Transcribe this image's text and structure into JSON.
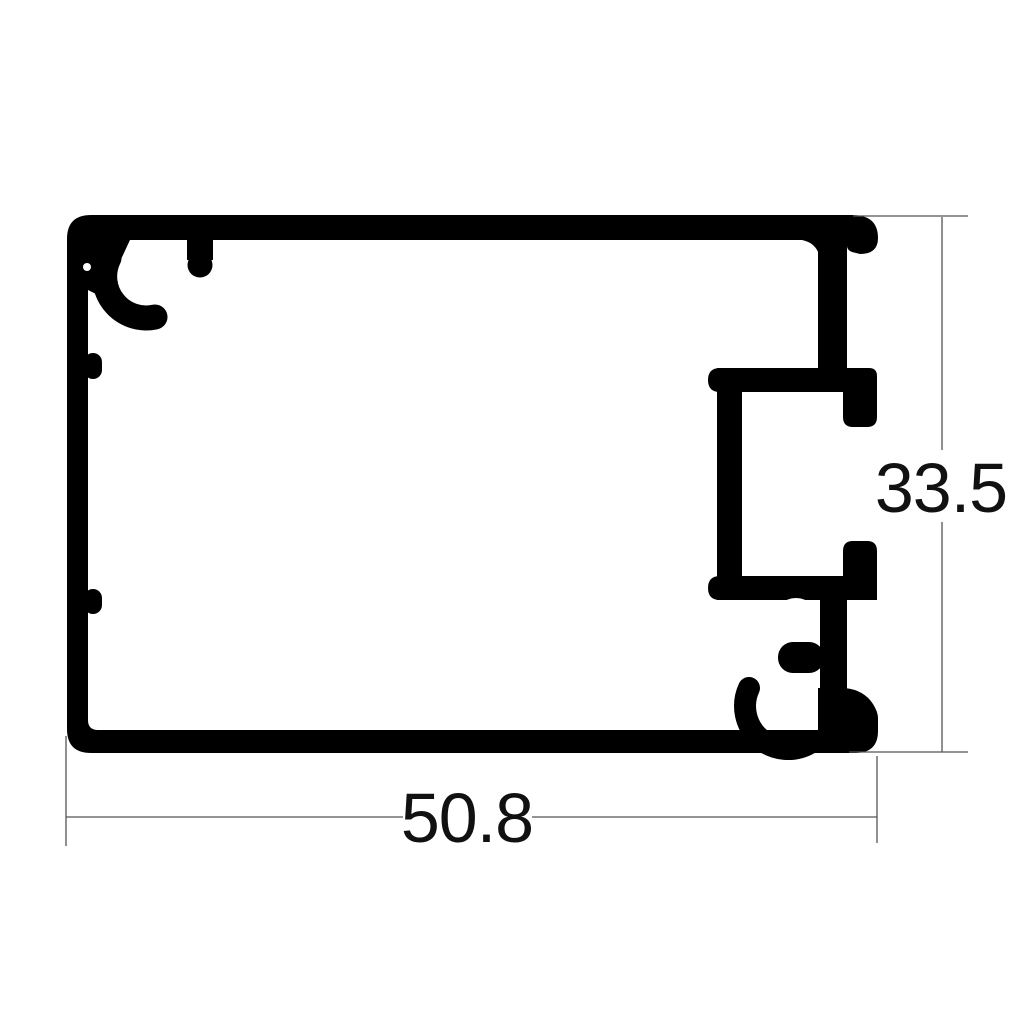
{
  "drawing": {
    "title": "aluminum-extrusion-profile-cross-section",
    "dimensions": {
      "width": {
        "value": "50.8",
        "orientation": "horizontal",
        "position": "bottom"
      },
      "height": {
        "value": "33.5",
        "orientation": "vertical",
        "position": "right"
      }
    },
    "colors": {
      "background": "#ffffff",
      "profile": "#000000",
      "dimension_lines": "#555555",
      "dimension_text": "#111111"
    },
    "features": [
      "rounded-rect-outer-profile",
      "screw-boss-top-left",
      "screw-boss-bottom-right",
      "c-channel-right-side",
      "two-inner-wall-nubs-left"
    ]
  }
}
